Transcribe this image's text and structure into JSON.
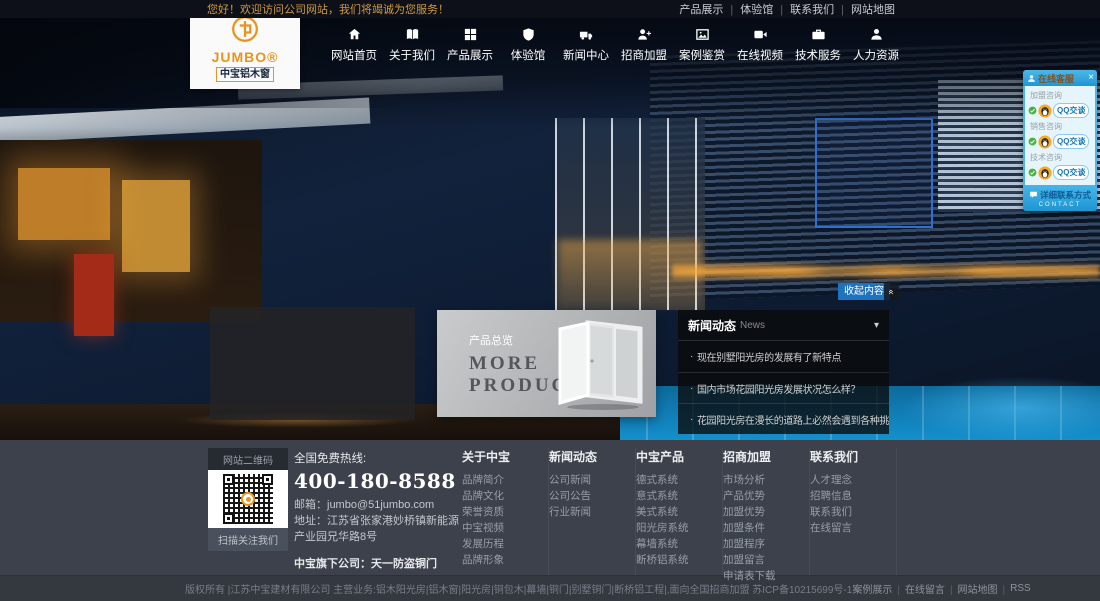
{
  "topbar": {
    "welcome": "您好！欢迎访问公司网站，我们将竭诚为您服务！",
    "links": [
      "产品展示",
      "体验馆",
      "联系我们",
      "网站地图"
    ]
  },
  "logo": {
    "name": "JUMBO®",
    "subtitle": "中宝铝木窗"
  },
  "nav": {
    "items": [
      {
        "label": "网站首页",
        "icon": "home-icon"
      },
      {
        "label": "关于我们",
        "icon": "book-icon"
      },
      {
        "label": "产品展示",
        "icon": "grid-icon"
      },
      {
        "label": "体验馆",
        "icon": "shield-icon"
      },
      {
        "label": "新闻中心",
        "icon": "truck-icon"
      },
      {
        "label": "招商加盟",
        "icon": "user-plus-icon"
      },
      {
        "label": "案例鉴赏",
        "icon": "photo-icon"
      },
      {
        "label": "在线视频",
        "icon": "video-icon"
      },
      {
        "label": "技术服务",
        "icon": "briefcase-icon"
      },
      {
        "label": "人力资源",
        "icon": "user-icon"
      }
    ]
  },
  "qq": {
    "title": "在线客服",
    "close": "×",
    "groups": [
      {
        "label": "加盟咨询",
        "button": "QQ交谈"
      },
      {
        "label": "销售咨询",
        "button": "QQ交谈"
      },
      {
        "label": "技术咨询",
        "button": "QQ交谈"
      }
    ],
    "contact_label": "详细联系方式",
    "contact_sub": "CONTACT"
  },
  "hero": {
    "collapse_label": "收起内容",
    "collapse_chevron": "«"
  },
  "products": {
    "title_cn": "产品总览",
    "title_en_line1": "MORE",
    "title_en_line2": "PRODUCTS"
  },
  "news": {
    "title": "新闻动态",
    "title_en": "News",
    "caret": "▾",
    "items": [
      "现在别墅阳光房的发展有了新特点",
      "国内市场花园阳光房发展状况怎么样？",
      "花园阳光房在漫长的道路上必然会遇到各种挑战"
    ]
  },
  "footer": {
    "qrcode": {
      "title": "网站二维码",
      "caption": "扫描关注我们"
    },
    "hotline_label": "全国免费热线:",
    "hotline": "400-180-8588",
    "email_label": "邮箱：",
    "email": "jumbo@51jumbo.com",
    "address_label": "地址：",
    "address": "江苏省张家港妙桥镇新能源产业园兄华路8号",
    "subsidiary": "中宝旗下公司：天一防盗铜门",
    "columns": [
      {
        "title": "关于中宝",
        "links": [
          "品牌简介",
          "品牌文化",
          "荣誉资质",
          "中宝视频",
          "发展历程",
          "品牌形象"
        ]
      },
      {
        "title": "新闻动态",
        "links": [
          "公司新闻",
          "公司公告",
          "行业新闻"
        ]
      },
      {
        "title": "中宝产品",
        "links": [
          "德式系统",
          "意式系统",
          "美式系统",
          "阳光房系统",
          "幕墙系统",
          "断桥铝系统"
        ]
      },
      {
        "title": "招商加盟",
        "links": [
          "市场分析",
          "产品优势",
          "加盟优势",
          "加盟条件",
          "加盟程序",
          "加盟留言",
          "申请表下载"
        ]
      },
      {
        "title": "联系我们",
        "links": [
          "人才理念",
          "招聘信息",
          "联系我们",
          "在线留言"
        ]
      }
    ]
  },
  "bottombar": {
    "copyright": "版权所有 |江苏中宝建材有限公司 主营业务:铝木阳光房|铝木窗|阳光房|铜包木|幕墙|铜门|别墅铜门|断桥铝工程|,面向全国招商加盟 苏ICP备10215699号-1",
    "links": [
      "案例展示",
      "在线留言",
      "网站地图",
      "RSS"
    ]
  },
  "colors": {
    "brand_orange": "#e8941f",
    "topbar_welcome": "#cf9a3f",
    "qq_blue": "#2aa8e0",
    "collapse_blue": "#1e73be",
    "footer_bg": "#3c414b",
    "hero_select_blue": "#2e6fd4"
  }
}
